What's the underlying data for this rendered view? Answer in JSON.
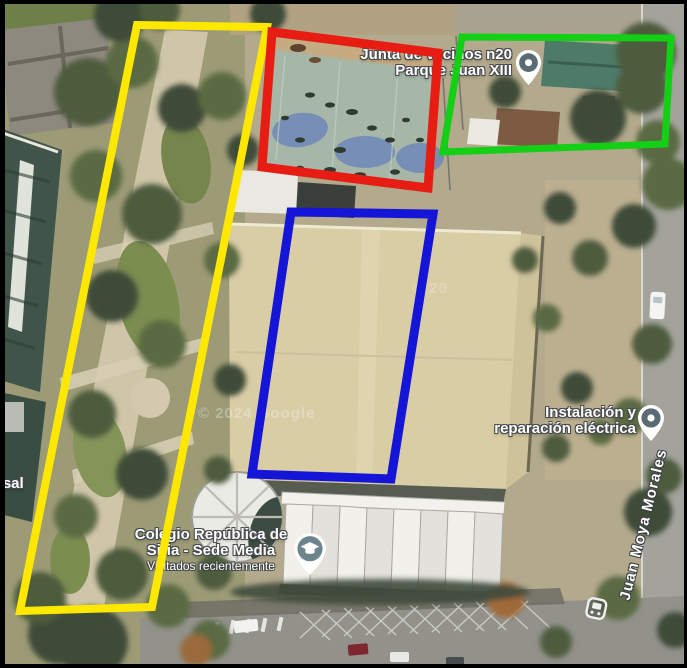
{
  "map_labels": {
    "junta": {
      "line1": "Junta de vecinos n20",
      "line2": "Parque Juan XIII"
    },
    "instalacion": {
      "line1": "Instalación y",
      "line2": "reparación eléctrica"
    },
    "colegio": {
      "line1": "Colegio República de",
      "line2": "Siria - Sede Media",
      "subtitle": "Visitados recientemente"
    },
    "street_name": "Juan Moya Morales",
    "partial_left_text": "rsal",
    "watermark": "© 2024 Google",
    "watermark_partial": "© 20"
  },
  "annotations": {
    "yellow": {
      "id": "yellow-zone",
      "color": "#ffe800"
    },
    "red": {
      "id": "red-zone",
      "color": "#e71d13"
    },
    "green": {
      "id": "green-zone",
      "color": "#13cf16"
    },
    "blue": {
      "id": "blue-zone",
      "color": "#1515d8"
    }
  },
  "icons": {
    "junta_pin": "location-pin",
    "instalacion_pin": "location-pin",
    "school_pin": "school-pin",
    "bus_stop": "bus-stop-icon"
  },
  "pin_colors": {
    "pin_circle": "#5b6b73",
    "school_circle": "#6d848d",
    "pin_body": "#ffffff"
  }
}
